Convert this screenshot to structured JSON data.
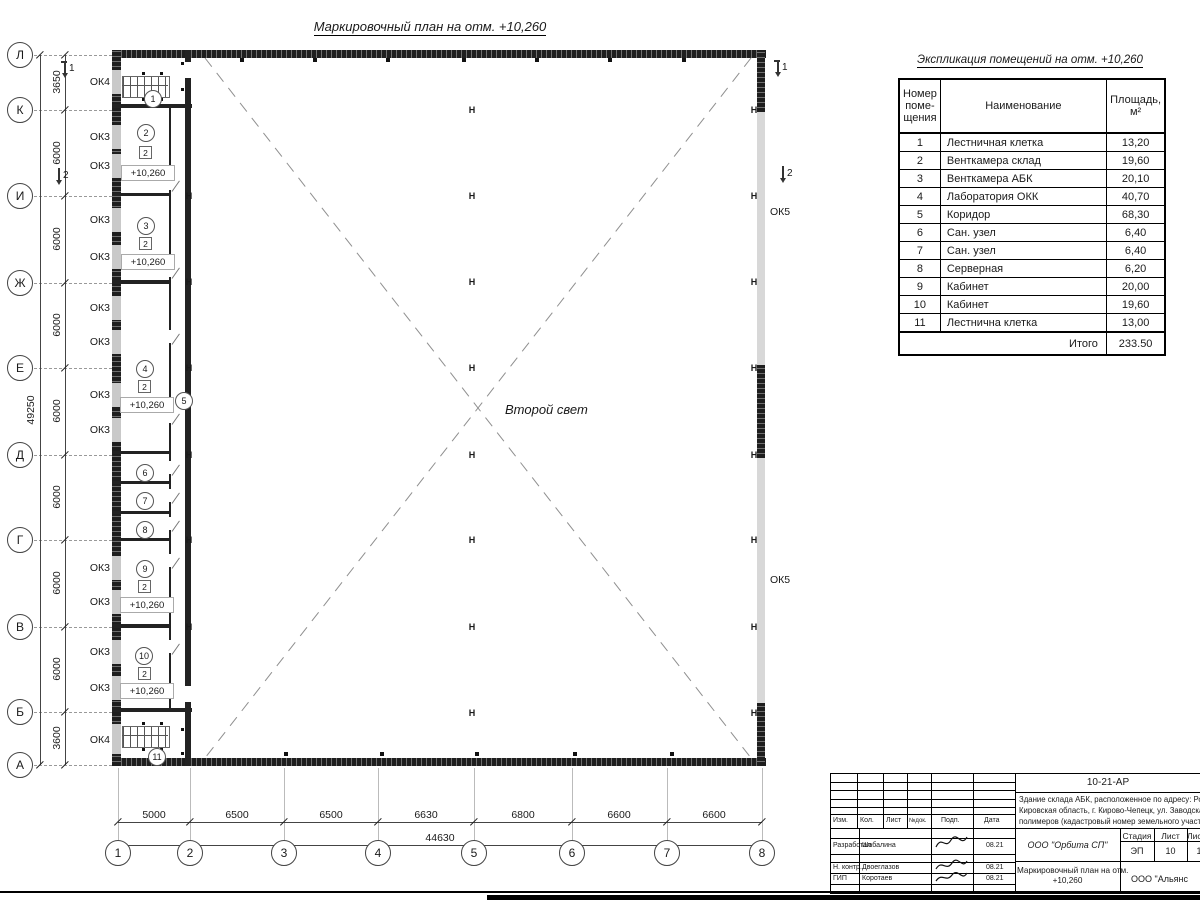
{
  "title": "Маркировочный план на отм. +10,260",
  "plan": {
    "axes_v": [
      "Л",
      "К",
      "И",
      "Ж",
      "Е",
      "Д",
      "Г",
      "В",
      "Б",
      "А"
    ],
    "axes_h": [
      "1",
      "2",
      "3",
      "4",
      "5",
      "6",
      "7",
      "8"
    ],
    "dims_v": [
      "3650",
      "6000",
      "6000",
      "6000",
      "6000",
      "6000",
      "6000",
      "6000",
      "3600"
    ],
    "dims_v_total": "49250",
    "dims_h": [
      "5000",
      "6500",
      "6500",
      "6630",
      "6800",
      "6600",
      "6600"
    ],
    "dims_h_total": "44630",
    "ok_left": [
      "ОК4",
      "ОК3",
      "ОК3",
      "ОК3",
      "ОК3",
      "ОК3",
      "ОК3",
      "ОК3",
      "ОК3",
      "ОК3",
      "ОК3",
      "ОК3",
      "ОК3",
      "ОК4"
    ],
    "ok_right": [
      "ОК5",
      "ОК5"
    ],
    "sections": [
      "1",
      "2",
      "1",
      "2"
    ],
    "rooms": [
      "1",
      "2",
      "3",
      "4",
      "5",
      "6",
      "7",
      "8",
      "9",
      "10",
      "11"
    ],
    "type_mark": "2",
    "level_mark": "+10,260",
    "column_mark": "Н",
    "second_light": "Второй свет"
  },
  "schedule": {
    "title": "Экспликация помещений на отм. +10,260",
    "col_num": "Номер\nпоме-\nщения",
    "col_name": "Наименование",
    "col_area": "Площадь,\nм²",
    "rows": [
      {
        "n": "1",
        "name": "Лестничная клетка",
        "area": "13,20"
      },
      {
        "n": "2",
        "name": "Венткамера склад",
        "area": "19,60"
      },
      {
        "n": "3",
        "name": "Венткамера АБК",
        "area": "20,10"
      },
      {
        "n": "4",
        "name": "Лаборатория ОКК",
        "area": "40,70"
      },
      {
        "n": "5",
        "name": "Коридор",
        "area": "68,30"
      },
      {
        "n": "6",
        "name": "Сан. узел",
        "area": "6,40"
      },
      {
        "n": "7",
        "name": "Сан. узел",
        "area": "6,40"
      },
      {
        "n": "8",
        "name": "Серверная",
        "area": "6,20"
      },
      {
        "n": "9",
        "name": "Кабинет",
        "area": "20,00"
      },
      {
        "n": "10",
        "name": "Кабинет",
        "area": "19,60"
      },
      {
        "n": "11",
        "name": "Лестнична клетка",
        "area": "13,00"
      }
    ],
    "total_label": "Итого",
    "total_value": "233.50"
  },
  "titleblock": {
    "doc_number": "10-21-АР",
    "address_lines": [
      "Здание склада АБК, расположенное по адресу: Российская Феде",
      "Кировская область, г. Кирово-Чепецк, ул. Заводская, площадка з",
      "полимеров (кадастровый номер земельного участка 43:42:0000"
    ],
    "cols": [
      "Изм.",
      "Кол.",
      "Лист",
      "№док.",
      "Подп.",
      "Дата"
    ],
    "sig_rows": [
      {
        "role": "Разработал",
        "name": "Шабалина",
        "date": "08.21"
      },
      {
        "role": "Н. контр.",
        "name": "Двоеглазов",
        "date": "08.21"
      },
      {
        "role": "ГИП",
        "name": "Коротаев",
        "date": "08.21"
      }
    ],
    "org": "ООО \"Орбита СП\"",
    "stage_label": "Стадия",
    "sheet_label": "Лист",
    "sheets_label": "Листов",
    "stage": "ЭП",
    "sheet": "10",
    "sheets": "1",
    "drawing_title_lines": [
      "Маркировочный план на отм.",
      "+10,260"
    ],
    "company": "ООО \"Альянс"
  }
}
